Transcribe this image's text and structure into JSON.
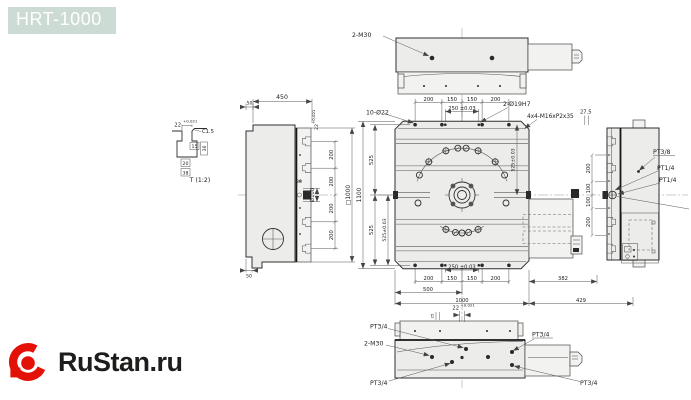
{
  "header": {
    "title": "HRT-1000"
  },
  "logo": {
    "brand": "RuStan.ru"
  },
  "colors": {
    "title-bg": "#ccdbd4",
    "title-text": "#ffffff",
    "logo-red": "#e31108",
    "ink": "#1d1d1b"
  },
  "views": {
    "top": {
      "label_2m30": "2-M30"
    },
    "left": {
      "dim_450": "450",
      "dim_50_top": "50",
      "dim_50_bottom": "50",
      "dim_30": "30",
      "dim_d100": "Ø100",
      "pitch": [
        "200",
        "200",
        "200",
        "200"
      ],
      "dim_sq1000": "□1000",
      "dim_22": "22",
      "tol_22": "+0.021"
    },
    "detail_t": {
      "dim_22": "22",
      "tol_22": "+0.021",
      "chamfer": "C1.5",
      "dim_15": "15",
      "dim_36": "36",
      "dim_20": "20",
      "dim_38": "38",
      "title": "T (1:2)"
    },
    "plan": {
      "label_10d22": "10-Ø22",
      "label_2d19h7": "2-Ø19H7",
      "label_m16": "4x4-M16xP2x35",
      "dim_275": "27.5",
      "top_dims": [
        "200",
        "150",
        "150",
        "200"
      ],
      "dim_250_top": "250 ±0.03",
      "dim_250_bottom": "250 ±0.03",
      "bottom_dims": [
        "200",
        "150",
        "150",
        "200"
      ],
      "dim_500": "500",
      "dim_1000": "1000",
      "dim_382": "382",
      "dim_429": "429",
      "dim_1100": "1100",
      "dim_525_top": "525",
      "dim_525_bottom": "525",
      "dim_525_tol_left": "525±0.03",
      "dim_525_tol_right": "525±0.03"
    },
    "right": {
      "label_pt38": "PT3/8",
      "label_pt14_a": "PT1/4",
      "label_pt14_b": "PT1/4",
      "dims": [
        "200",
        "100",
        "100",
        "200"
      ]
    },
    "bottom": {
      "dim_22": "22",
      "tol_22": "+0.021",
      "dim_25": "25",
      "label_2m30": "2-M30",
      "pt34_top_left": "PT3/4",
      "pt34_bottom_left": "PT3/4",
      "pt34_top_right": "PT3/4",
      "pt34_bottom_right": "PT3/4"
    }
  }
}
